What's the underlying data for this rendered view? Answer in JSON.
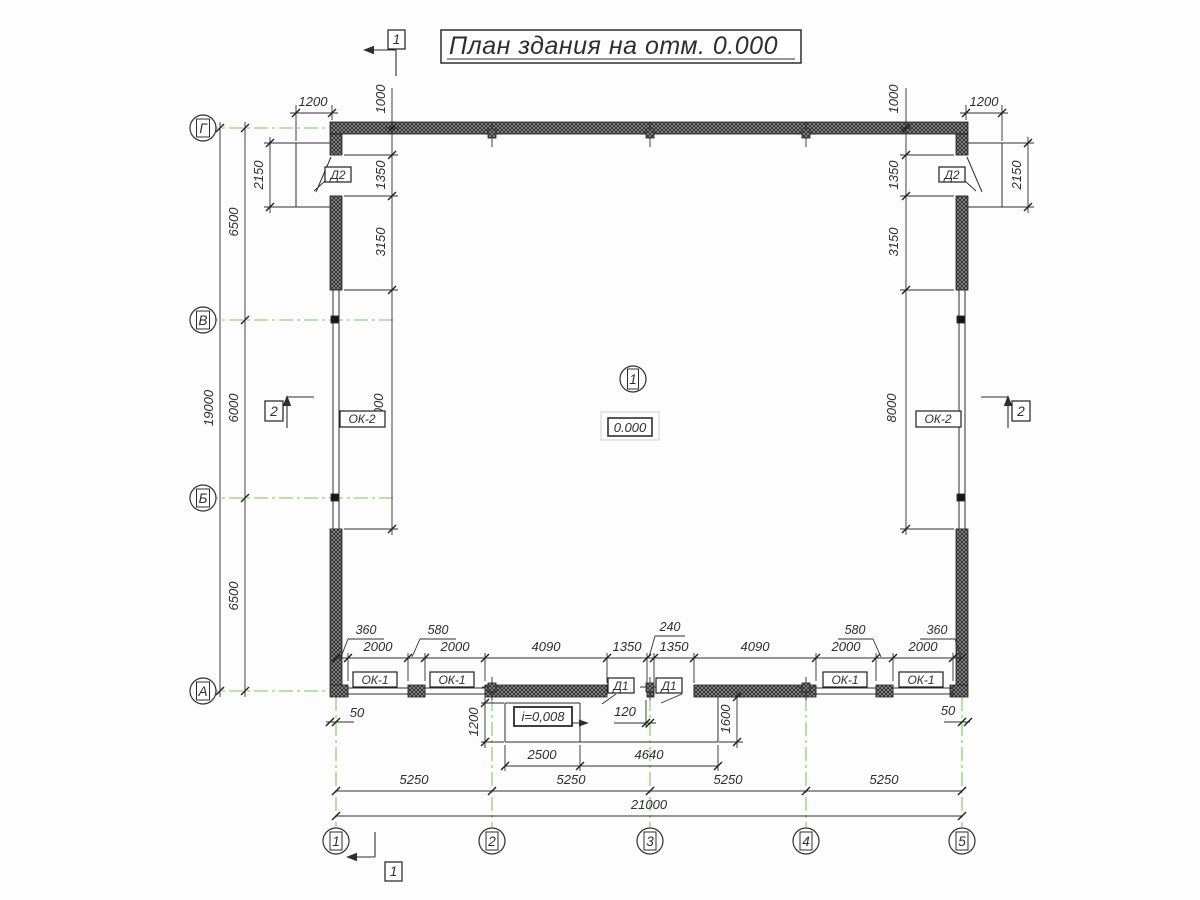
{
  "title": "План здания на отм. 0.000",
  "axes": {
    "rows": [
      "Г",
      "В",
      "Б",
      "А"
    ],
    "cols": [
      "1",
      "2",
      "3",
      "4",
      "5"
    ]
  },
  "sections": {
    "s1": "1",
    "s2": "2"
  },
  "room": {
    "number": "1",
    "elevation": "0.000"
  },
  "labels": {
    "door_exterior": "Д2",
    "door_interior": "Д1",
    "window_small": "ОК-1",
    "window_large": "ОК-2",
    "slope": "i=0,008"
  },
  "dims": {
    "total_width": "21000",
    "total_height": "19000",
    "col_spans": [
      "5250",
      "5250",
      "5250",
      "5250"
    ],
    "row_spans": [
      "6500",
      "6000",
      "6500"
    ],
    "swing_width": "1200",
    "swing_height": "2150",
    "side": [
      "1000",
      "1350",
      "3150",
      "8000"
    ],
    "bottom_row": [
      "2000",
      "2000",
      "4090",
      "1350",
      "1350",
      "4090",
      "2000",
      "2000"
    ],
    "bottom_piers": [
      "360",
      "580",
      "240",
      "580",
      "360"
    ],
    "offset": "50",
    "pier_half": "120",
    "ramp_length": "2500",
    "landing_length": "4640",
    "ramp_width": "1200",
    "landing_width": "1600"
  }
}
